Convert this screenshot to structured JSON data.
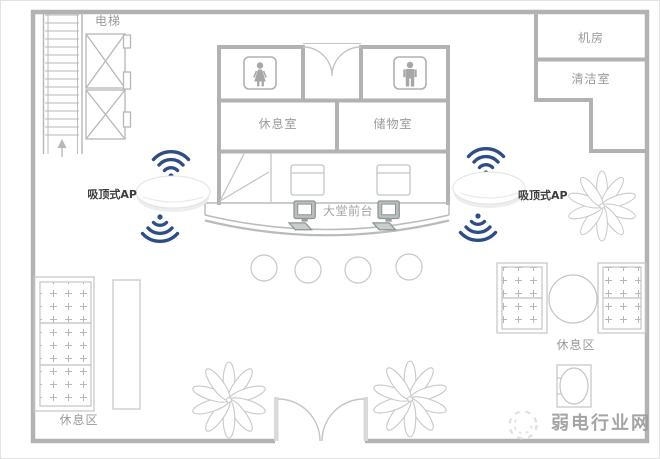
{
  "labels": {
    "elevator": "电梯",
    "equipment_room": "机房",
    "cleaning_room": "清洁室",
    "lounge_room": "休息室",
    "storage_room": "储物室",
    "front_desk": "大堂前台",
    "ap_left": "吸顶式AP",
    "ap_right": "吸顶式AP",
    "rest_area_left": "休息区",
    "rest_area_right": "休息区",
    "watermark": "弱电行业网"
  },
  "icons": {
    "stairs": "stairs-icon (hatched strip with up arrow)",
    "elevator_shafts": "elevator-shaft-icon (two X boxes)",
    "female_restroom": "female-restroom-icon (woman pictogram in rounded square)",
    "male_restroom": "male-restroom-icon (man pictogram in rounded square)",
    "back_double_door": "double-door-icon (two quarter-circle leaves)",
    "entrance_double_door": "double-door-icon (two quarter-circle leaves)",
    "ceiling_ap": "ceiling-ap-icon (white dome device)",
    "wifi": "wifi-signal-icon (three navy arcs with dot)",
    "computer": "computer-icon (monitor with keyboard)",
    "plant": "plant-icon (ten-petal flower, plan view)",
    "sofa": "sofa-icon (tufted cushions with plus marks)",
    "round_table": "round-table-icon",
    "stool": "stool-icon",
    "watermark_logo": "sketch-circle-logo-icon"
  },
  "colors": {
    "wall": "#b2b2b2",
    "furniture_line": "#c5c8c8",
    "wifi_signal": "#2e4d85",
    "room_label": "#9a9a9a",
    "ap_label": "#3c3c3c",
    "watermark": "#9b9b9b",
    "background": "#ffffff"
  }
}
